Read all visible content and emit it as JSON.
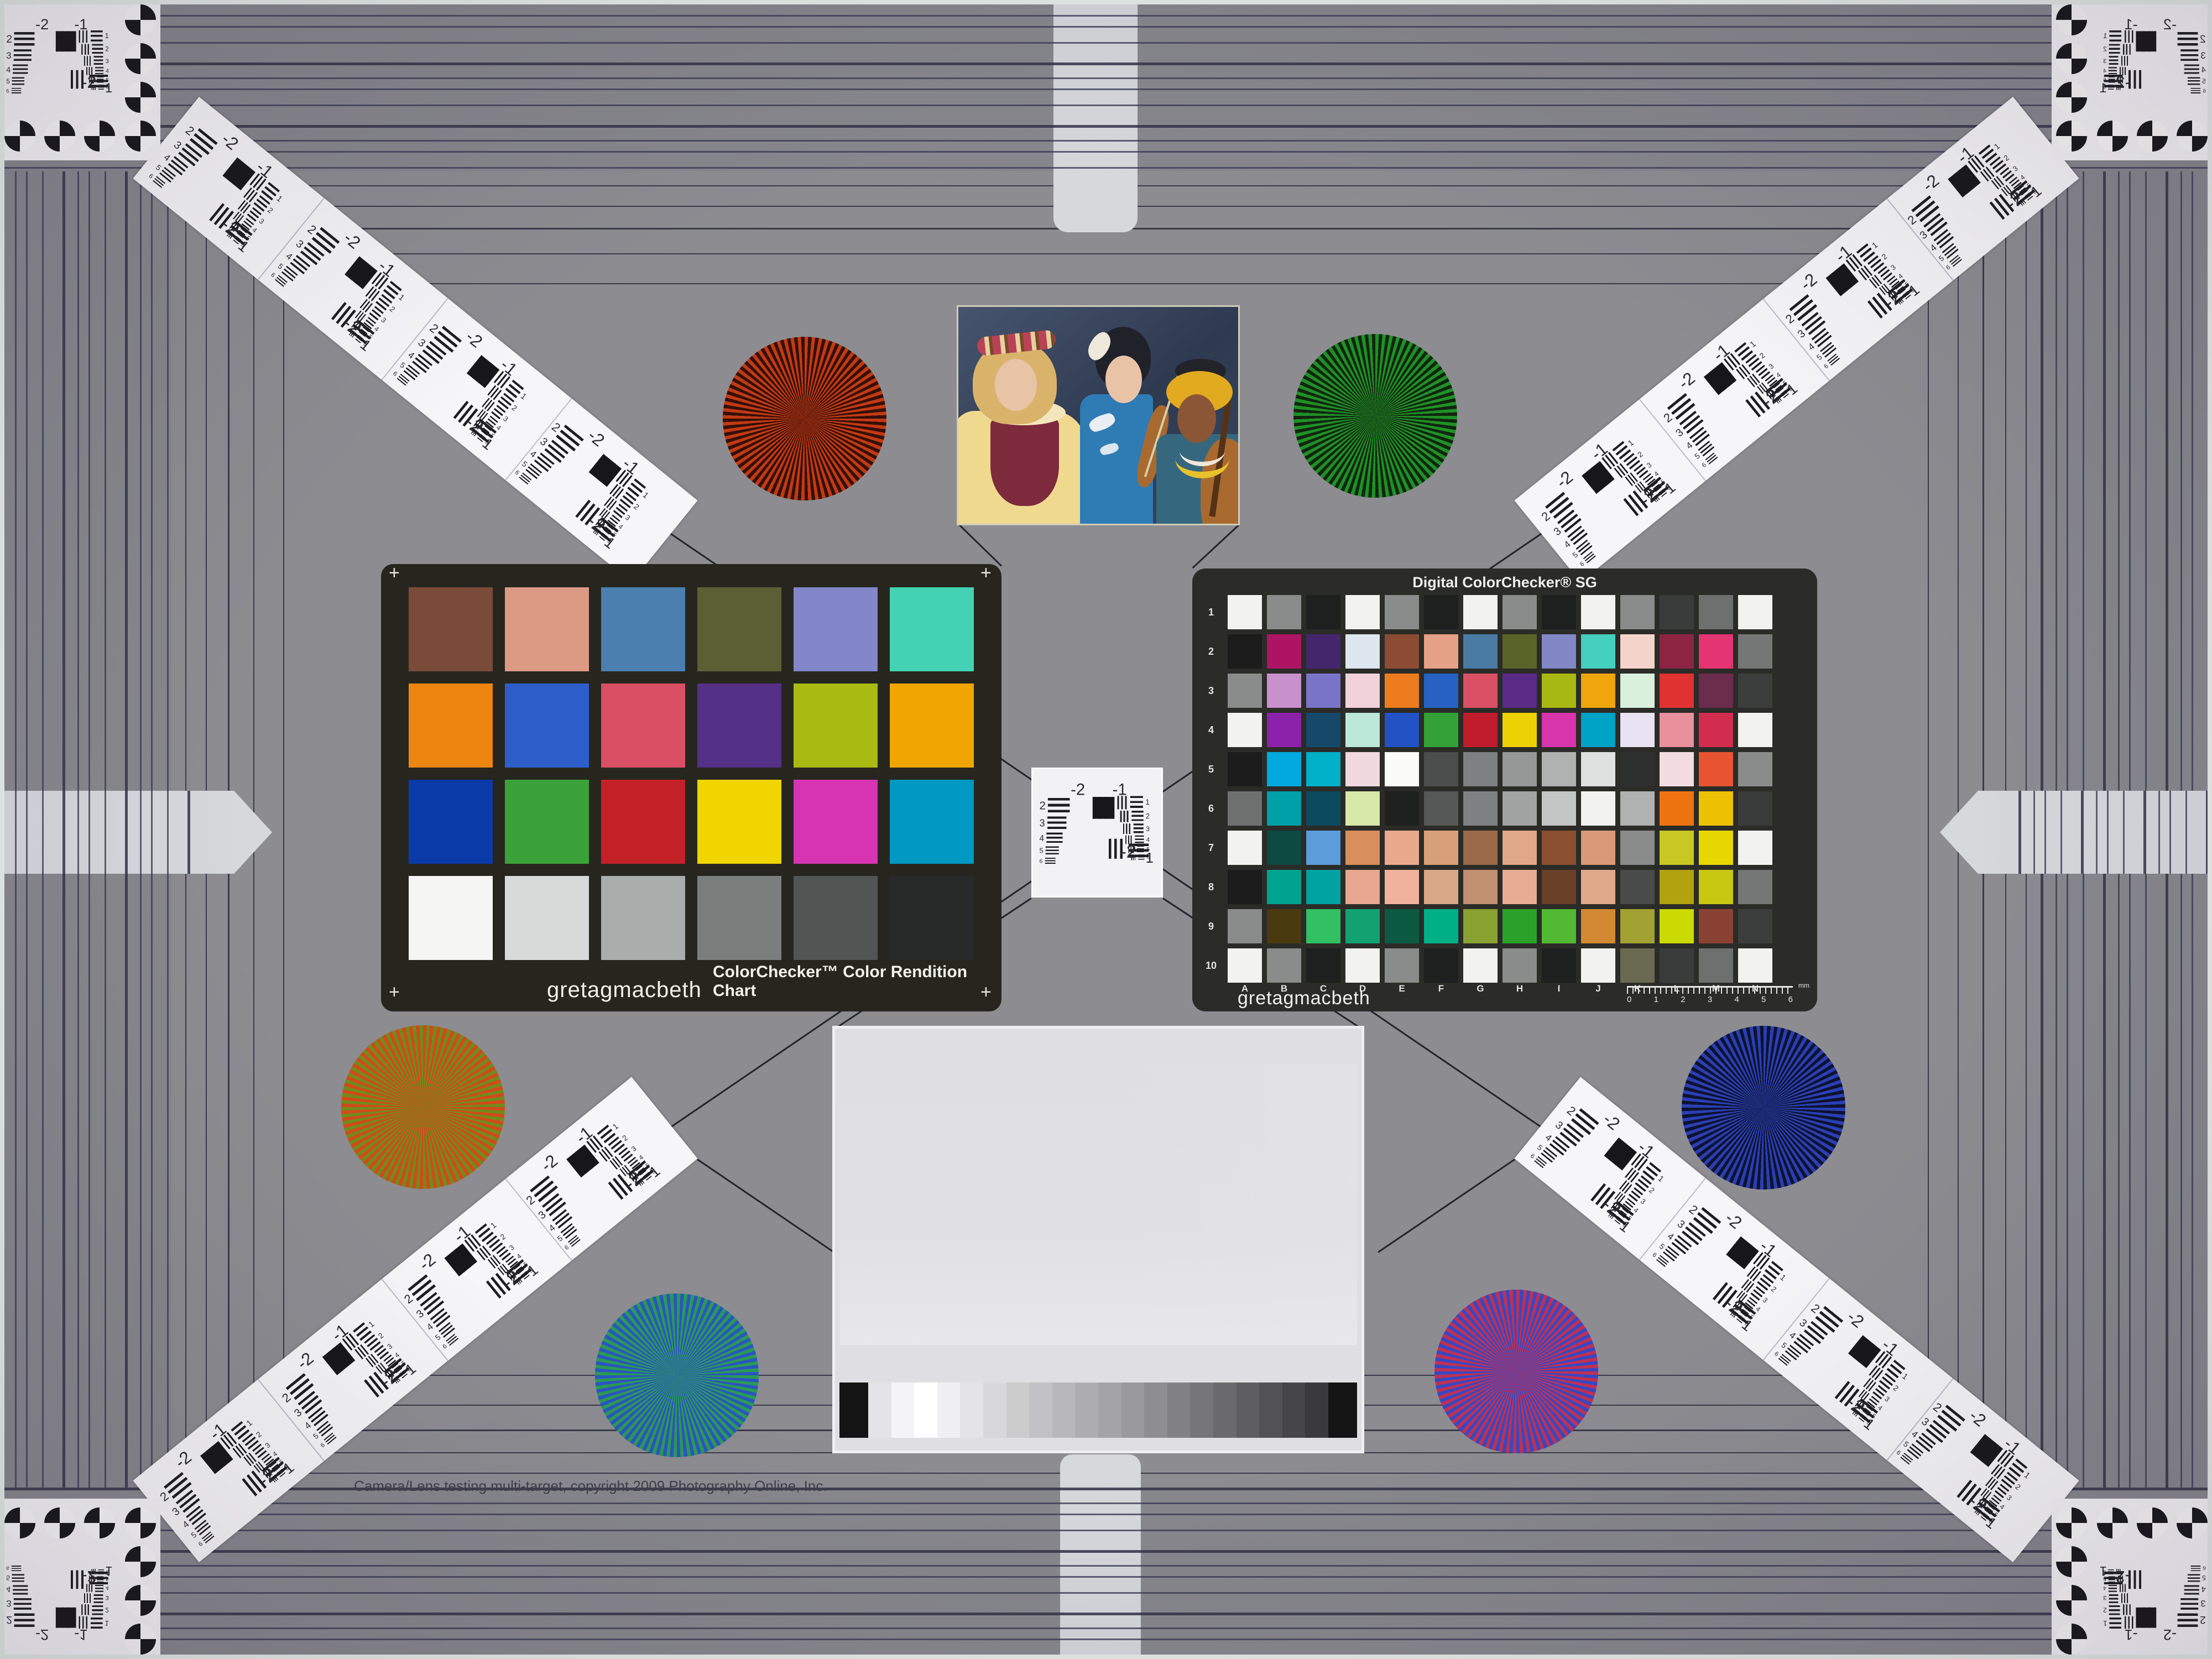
{
  "page": {
    "copyright": "Camera/Lens testing multi-target, copyright 2009 Photography Online, Inc.",
    "field_color": "#8c8c91",
    "border_line_color": "#3f3f50",
    "edge_color": "#e6ece8"
  },
  "colorchecker": {
    "brand": "gretagmacbeth",
    "title": "ColorChecker™ Color Rendition Chart",
    "corner_mark": "+",
    "patches": [
      "#7a4b39",
      "#dc9a84",
      "#4a7fb0",
      "#5a6033",
      "#8187c8",
      "#43d2b3",
      "#ee8511",
      "#2e5ec9",
      "#d94f63",
      "#543086",
      "#a9ba12",
      "#f0a500",
      "#0a3aa8",
      "#3ba239",
      "#c32127",
      "#f0d500",
      "#d734b3",
      "#0099c4",
      "#f5f5f3",
      "#d7dad8",
      "#a9aeac",
      "#7a7f7e",
      "#515554",
      "#272a29"
    ]
  },
  "sg": {
    "title": "Digital ColorChecker® SG",
    "brand": "gretagmacbeth",
    "row_labels": [
      "1",
      "2",
      "3",
      "4",
      "5",
      "6",
      "7",
      "8",
      "9",
      "10"
    ],
    "col_labels": [
      "A",
      "B",
      "C",
      "D",
      "E",
      "F",
      "G",
      "H",
      "I",
      "J",
      "K",
      "L",
      "M",
      "N"
    ],
    "ruler": {
      "numbers": [
        "0",
        "1",
        "2",
        "3",
        "4",
        "5",
        "6"
      ],
      "unit": "mm"
    },
    "rows": [
      [
        "#f2f2ef",
        "#8a8c8b",
        "#1e1f1f",
        "#f2f2ef",
        "#8a8c8b",
        "#1e1f1f",
        "#f2f2ef",
        "#8a8c8b",
        "#1e1f1f",
        "#f2f2ef",
        "#8a8c8b",
        "#3a3b3b",
        "#6e7070",
        "#f2f2ef"
      ],
      [
        "#1c1c1c",
        "#ad1464",
        "#43266c",
        "#dde6ee",
        "#8c4c34",
        "#e5a186",
        "#4a7ba4",
        "#5a6428",
        "#8287c6",
        "#44cfbe",
        "#f4d4ca",
        "#8c2442",
        "#e43472",
        "#757777"
      ],
      [
        "#8a8c8b",
        "#c890cc",
        "#7a74c8",
        "#f2d2da",
        "#ec7c1e",
        "#2662c4",
        "#da5064",
        "#5a2c88",
        "#a8b812",
        "#eea60c",
        "#d9f0dc",
        "#e03230",
        "#6c2c4c",
        "#3c3d3d"
      ],
      [
        "#f2f2ef",
        "#8c22aa",
        "#16486a",
        "#bce8da",
        "#2252c4",
        "#34a136",
        "#c01c2c",
        "#ecd204",
        "#d834ac",
        "#00a2c6",
        "#e8e2f2",
        "#e8909c",
        "#d22c4e",
        "#f2f2ef"
      ],
      [
        "#1c1c1c",
        "#00aade",
        "#00b0c8",
        "#f0dade",
        "#fbfbf8",
        "#4c4e4e",
        "#7e8081",
        "#969898",
        "#b0b2b1",
        "#dfe1e0",
        "#2e2f2f",
        "#f2dce2",
        "#e85432",
        "#8a8c8b"
      ],
      [
        "#6e7070",
        "#00a0a8",
        "#0c4a60",
        "#d8e8a8",
        "#1f2020",
        "#565858",
        "#7e8081",
        "#a2a4a3",
        "#c4c6c5",
        "#f2f2ef",
        "#b0b2b1",
        "#ee7412",
        "#eec204",
        "#3a3b3b"
      ],
      [
        "#f2f2ef",
        "#0c4a42",
        "#5c9cda",
        "#d98e5e",
        "#e8a98c",
        "#d8a078",
        "#9a6a4a",
        "#e0a888",
        "#8a5030",
        "#d89a78",
        "#8a8c8b",
        "#c8c822",
        "#e8d802",
        "#f2f2ef"
      ],
      [
        "#1c1c1c",
        "#00a290",
        "#00a2a2",
        "#e8a890",
        "#f0b29c",
        "#d8a888",
        "#c09070",
        "#e8ac92",
        "#6a4028",
        "#e0a98a",
        "#4a4b4b",
        "#b2a210",
        "#c8c810",
        "#757777"
      ],
      [
        "#8a8c8b",
        "#4a3a10",
        "#32c062",
        "#12a272",
        "#0c5a42",
        "#02b088",
        "#8aa232",
        "#2aa22a",
        "#52ba32",
        "#d28a32",
        "#a2a232",
        "#cada02",
        "#8a4232",
        "#3c3d3d"
      ],
      [
        "#f2f2ef",
        "#8a8c8b",
        "#1e1f1f",
        "#f2f2ef",
        "#8a8c8b",
        "#1e1f1f",
        "#f2f2ef",
        "#8a8c8b",
        "#1e1f1f",
        "#f2f2ef",
        "#6a6a52",
        "#3a3b3b",
        "#6e7070",
        "#f2f2ef"
      ]
    ]
  },
  "usaf": {
    "tl": "-2",
    "tr": "-1",
    "br_group": "-2",
    "br_elem": "1",
    "left_digits": [
      "2",
      "3",
      "4",
      "5",
      "6"
    ],
    "right_digits": [
      "1",
      "2",
      "3",
      "4",
      "5",
      "6"
    ]
  },
  "stars": [
    {
      "id": "red",
      "colors": [
        "#c23a14",
        "#351008"
      ]
    },
    {
      "id": "green",
      "colors": [
        "#1f9126",
        "#11260f"
      ]
    },
    {
      "id": "orange",
      "colors": [
        "#d2491a",
        "#6f8c1c"
      ]
    },
    {
      "id": "blue",
      "colors": [
        "#2a3fb4",
        "#0d1330"
      ]
    },
    {
      "id": "teal",
      "colors": [
        "#2a9a55",
        "#2a55c0"
      ]
    },
    {
      "id": "magenta",
      "colors": [
        "#c03052",
        "#3548c4"
      ]
    }
  ],
  "sweep": {
    "steps": [
      "#141414",
      "#e4e4e6",
      "#f4f4f6",
      "#ffffff",
      "#f0f0f2",
      "#e4e4e6",
      "#d8d8da",
      "#cccccd",
      "#c2c2c4",
      "#b8b8ba",
      "#aeaeb0",
      "#a4a4a6",
      "#9a9a9c",
      "#8e8e90",
      "#828284",
      "#767678",
      "#6a6a6c",
      "#5e5e60",
      "#525254",
      "#464648",
      "#3a3a3c",
      "#141414"
    ]
  },
  "photo": {
    "palette": {
      "bg1": "#46546e",
      "bg2": "#2e3a50",
      "skin1": "#e9c3a6",
      "skin2": "#8a5636",
      "hairBlonde": "#d9b36a",
      "hairBlack": "#20222a",
      "dressYellow": "#efd98e",
      "vestMaroon": "#7c2a3c",
      "kimonoBlue": "#2f7cb5",
      "robeTeal": "#35687f",
      "wrapYellow": "#e2aa1e",
      "wood": "#a96a30",
      "woodDark": "#553217",
      "flower": "#b84355",
      "necklace": "#e8c12c",
      "collar": "#f4e6bc"
    }
  }
}
